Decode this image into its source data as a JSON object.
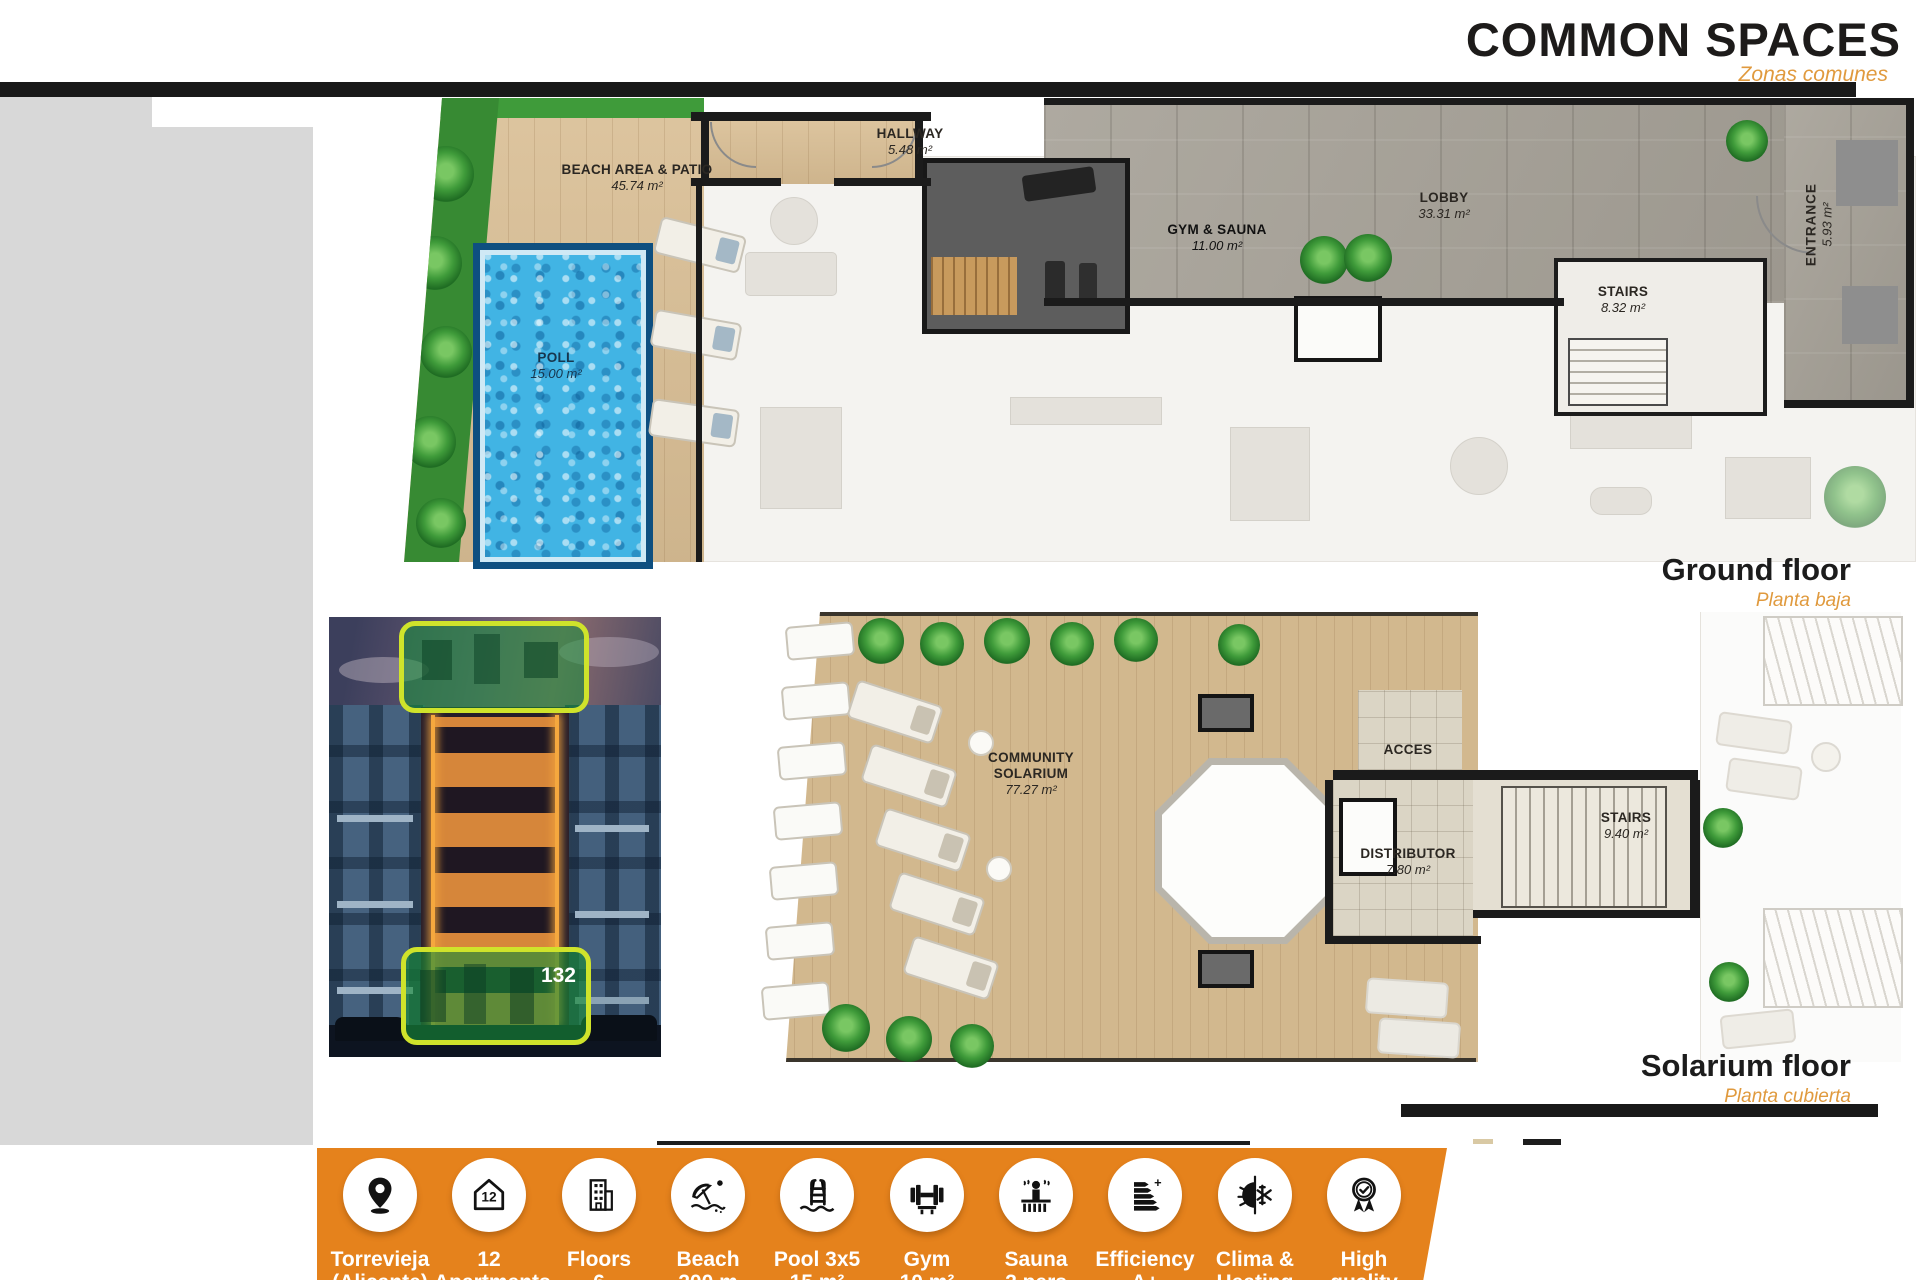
{
  "header": {
    "title": "COMMON SPACES",
    "subtitle": "Zonas comunes"
  },
  "ground_floor": {
    "caption": "Ground floor",
    "caption_es": "Planta baja",
    "rooms": {
      "beach": {
        "name": "BEACH AREA & PATIO",
        "area": "45.74 m²"
      },
      "pool": {
        "name": "POLL",
        "area": "15.00 m²"
      },
      "hallway": {
        "name": "HALLWAY",
        "area": "5.48 m²"
      },
      "gym": {
        "name": "GYM & SAUNA",
        "area": "11.00 m²"
      },
      "lobby": {
        "name": "LOBBY",
        "area": "33.31 m²"
      },
      "stairs": {
        "name": "STAIRS",
        "area": "8.32 m²"
      },
      "entrance": {
        "name": "ENTRANCE",
        "area": "5.93 m²"
      }
    }
  },
  "solarium_floor": {
    "caption": "Solarium floor",
    "caption_es": "Planta cubierta",
    "rooms": {
      "community": {
        "name": "COMMUNITY SOLARIUM",
        "area": "77.27 m²"
      },
      "acces": {
        "name": "ACCES",
        "area": ""
      },
      "distributor": {
        "name": "DISTRIBUTOR",
        "area": "7.80 m²"
      },
      "stairs": {
        "name": "STAIRS",
        "area": "9.40 m²"
      }
    }
  },
  "photo": {
    "badge": "132"
  },
  "features": [
    {
      "icon": "location-pin-icon",
      "line1": "Torrevieja",
      "line2": "(Alicante)"
    },
    {
      "icon": "apartments-icon",
      "line1": "12",
      "line2": "Apartments"
    },
    {
      "icon": "floors-icon",
      "line1": "Floors",
      "line2": "6"
    },
    {
      "icon": "beach-umbrella-icon",
      "line1": "Beach",
      "line2": "200 m"
    },
    {
      "icon": "pool-ladder-icon",
      "line1": "Pool 3x5",
      "line2": "15 m²"
    },
    {
      "icon": "gym-dumbbell-icon",
      "line1": "Gym",
      "line2": "10 m²"
    },
    {
      "icon": "sauna-icon",
      "line1": "Sauna",
      "line2": "2 pers"
    },
    {
      "icon": "efficiency-icon",
      "line1": "Efficiency",
      "line2": "A+"
    },
    {
      "icon": "climate-icon",
      "line1": "Clima &",
      "line2": "Heating"
    },
    {
      "icon": "quality-icon",
      "line1": "High",
      "line2": "quality"
    }
  ],
  "colors": {
    "accent_bar": "#E5821C",
    "subtitle_orange": "#E09A3E",
    "header_bar": "#191919"
  }
}
